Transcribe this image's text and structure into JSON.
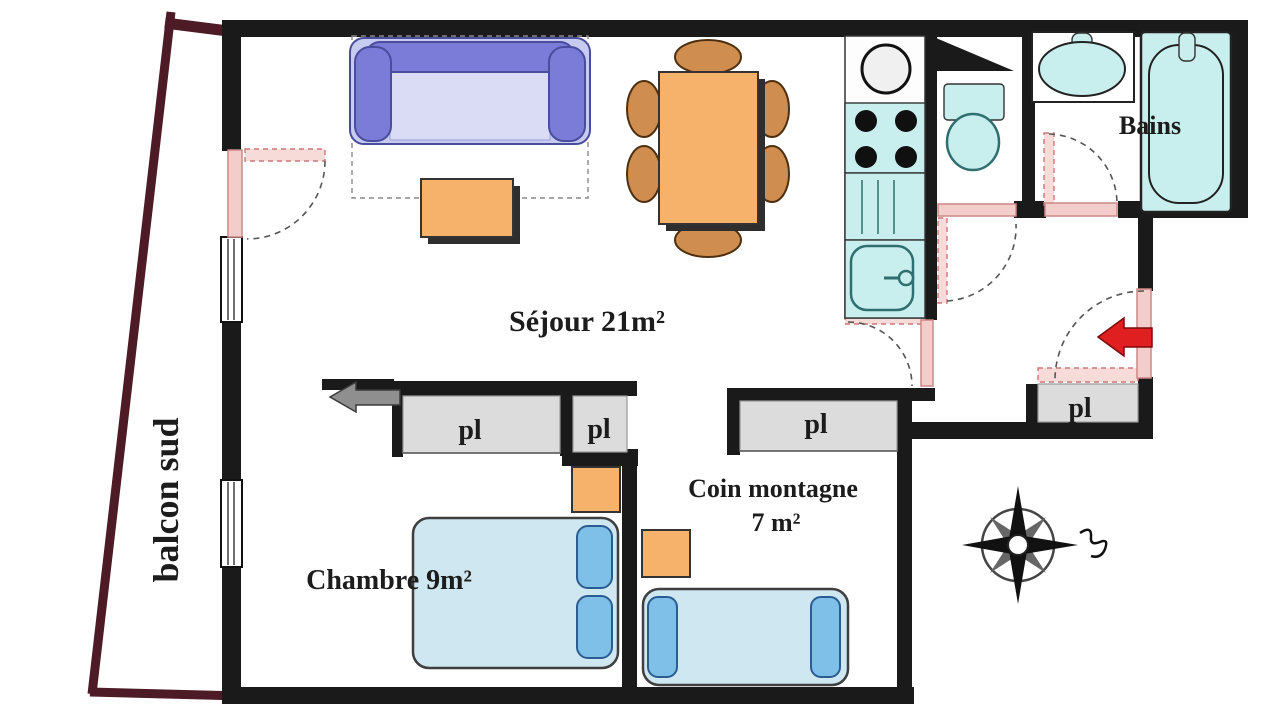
{
  "title": "Apartment floor plan",
  "rooms": {
    "sejour": {
      "name": "Séjour 21m²"
    },
    "chambre": {
      "name": "Chambre 9m²"
    },
    "coin_montagne": {
      "name": "Coin montagne",
      "area": "7 m²"
    },
    "bains": {
      "name": "Bains"
    },
    "balcon": {
      "name": "balcon sud"
    }
  },
  "closet_label": "pl",
  "icons": {
    "compass": "compass-rose",
    "entrance_arrow": "red-arrow-left",
    "chambre_entry_arrow": "gray-arrow-left"
  },
  "colors": {
    "wall": "#1a1a1a",
    "balcony_wall": "#4d1b26",
    "door_pink": "#f3cdca",
    "closet": "#dcdcdc",
    "furniture_orange": "#f6b26b",
    "chair": "#cf8d4f",
    "sofa": "#7a7cd8",
    "sofa_base": "#c7cbf0",
    "bed": "#cfe7f0",
    "pillow": "#7fc0e8",
    "kitchen_fixture": "#c9eeee",
    "arrow_red": "#e02020",
    "arrow_gray": "#8f8f8f",
    "text": "#1c1c1c"
  }
}
